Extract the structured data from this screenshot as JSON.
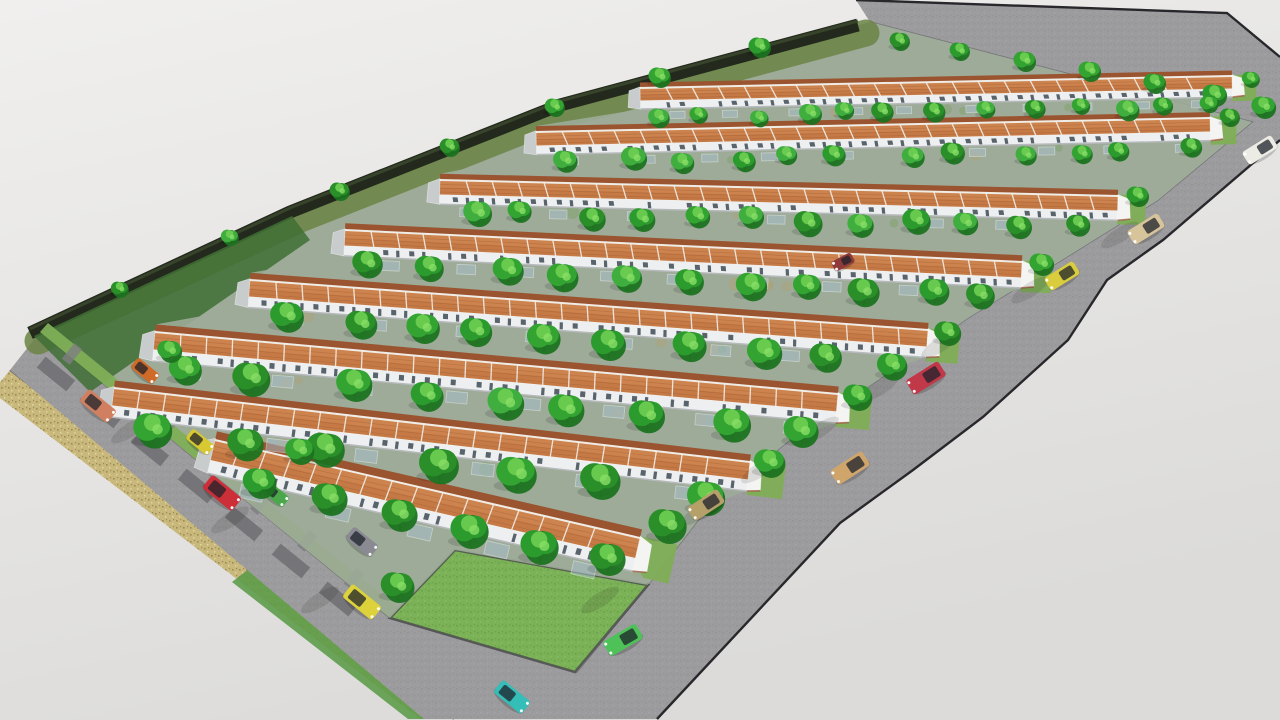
{
  "meta": {
    "kind": "3d-architectural-render",
    "subject": "terraced-housing-estate-site-plan",
    "canvas": {
      "w": 1280,
      "h": 720
    }
  },
  "palette": {
    "bg_top": "#f0efee",
    "bg_bottom": "#dcdbd9",
    "road": "#9c9c9e",
    "road_light": "#a6a6a8",
    "curb_dark": "#28282c",
    "curb_soft": "#6f6f72",
    "wall_band": "#c9b87b",
    "wall_speck1": "#9c8b55",
    "wall_speck2": "#e2d6a2",
    "hedge": "#23291c",
    "hedge_hi": "#3c4a2e",
    "hedge_verge": "#6b8444",
    "site_base": "#9dab98",
    "corner_grass": "#3f6f35",
    "lawn": "#7cb257",
    "lawn_speck": "#6aa248",
    "lawn_edge": "#4a4a4e",
    "verge": "#7fae57",
    "outer_grass": "#5d9c4a",
    "pad": "#6f6f72",
    "apron": "#7e7e81",
    "roof_far": "#9a5430",
    "roof_near": "#c57a46",
    "roof_light": "#d68f58",
    "tile_line": "#8c4c28",
    "ridge": "#f0ede7",
    "eave": "#f5f3ef",
    "wall_house": "#edeff0",
    "wall_shade": "#b7babc",
    "window": "#3d4a55",
    "brick": "#a14f3d",
    "gable_shade": "#c9cccd",
    "gable_lit": "#f4f4f2",
    "carport_glass": "#a9c0cf",
    "carport_frame": "#eef4f8",
    "tree_dark": "#1c7320",
    "tree_mids": [
      "#2c9b2e",
      "#33a431",
      "#2a8f29",
      "#3fae3f"
    ],
    "tree_light": "#6ecf52",
    "tree_light2": "#8adf66",
    "trunk": "#5a4a33",
    "shadow": "#000000"
  },
  "scene": {
    "seed": 7,
    "road_polygon": [
      [
        856,
        0
      ],
      [
        1227,
        13
      ],
      [
        1280,
        57
      ],
      [
        1280,
        140
      ],
      [
        1163,
        240
      ],
      [
        1107,
        280
      ],
      [
        1068,
        340
      ],
      [
        983,
        417
      ],
      [
        913,
        470
      ],
      [
        840,
        523
      ],
      [
        657,
        719
      ],
      [
        424,
        719
      ],
      [
        10,
        370
      ],
      [
        40,
        332
      ],
      [
        390,
        618
      ],
      [
        577,
        672
      ],
      [
        648,
        585
      ],
      [
        712,
        502
      ],
      [
        790,
        440
      ],
      [
        878,
        380
      ],
      [
        968,
        318
      ],
      [
        1065,
        258
      ],
      [
        1158,
        200
      ],
      [
        1252,
        122
      ],
      [
        870,
        22
      ]
    ],
    "outer_curb": [
      [
        856,
        0
      ],
      [
        1227,
        13
      ],
      [
        1280,
        57
      ]
    ],
    "outer_curb2": [
      [
        1280,
        140
      ],
      [
        1163,
        240
      ],
      [
        1107,
        280
      ],
      [
        1068,
        340
      ],
      [
        983,
        417
      ],
      [
        913,
        470
      ],
      [
        840,
        523
      ],
      [
        657,
        719
      ]
    ],
    "inner_boundary": [
      [
        40,
        332
      ],
      [
        390,
        618
      ],
      [
        577,
        672
      ],
      [
        648,
        585
      ],
      [
        712,
        502
      ],
      [
        790,
        440
      ],
      [
        878,
        380
      ],
      [
        968,
        318
      ],
      [
        1065,
        258
      ],
      [
        1158,
        200
      ],
      [
        1252,
        122
      ],
      [
        870,
        22
      ]
    ],
    "wall_band": [
      [
        10,
        370
      ],
      [
        454,
        719
      ],
      [
        420,
        719
      ],
      [
        -8,
        392
      ]
    ],
    "outer_grass_sliver": [
      [
        250,
        568
      ],
      [
        452,
        719
      ],
      [
        408,
        719
      ],
      [
        232,
        582
      ]
    ],
    "left_road_outer_line": [
      [
        10,
        370
      ],
      [
        454,
        719
      ]
    ],
    "site_polygon": [
      [
        40,
        332
      ],
      [
        390,
        618
      ],
      [
        577,
        672
      ],
      [
        648,
        585
      ],
      [
        712,
        502
      ],
      [
        790,
        440
      ],
      [
        878,
        380
      ],
      [
        968,
        318
      ],
      [
        1065,
        258
      ],
      [
        1158,
        200
      ],
      [
        1252,
        122
      ],
      [
        870,
        22
      ],
      [
        858,
        25
      ],
      [
        560,
        105
      ],
      [
        290,
        212
      ],
      [
        30,
        333
      ]
    ],
    "hedge_line": [
      [
        30,
        333
      ],
      [
        290,
        212
      ],
      [
        560,
        105
      ],
      [
        858,
        25
      ]
    ],
    "hedge_width": 13,
    "corner_grass_patch": [
      [
        34,
        336
      ],
      [
        292,
        216
      ],
      [
        310,
        240
      ],
      [
        90,
        392
      ]
    ],
    "left_verge": [
      [
        40,
        332
      ],
      [
        390,
        618
      ],
      [
        398,
        608
      ],
      [
        48,
        323
      ]
    ],
    "lawn": [
      [
        455,
        550
      ],
      [
        648,
        585
      ],
      [
        575,
        672
      ],
      [
        390,
        618
      ]
    ],
    "pads": [
      [
        56,
        374
      ],
      [
        103,
        411
      ],
      [
        150,
        449
      ],
      [
        197,
        486
      ],
      [
        244,
        524
      ],
      [
        291,
        561
      ],
      [
        338,
        599
      ]
    ],
    "pad_size": [
      38,
      14
    ],
    "pad_rot": 39,
    "apron_offset": [
      16,
      -20
    ],
    "apron_size": [
      10,
      20
    ],
    "rows": [
      {
        "x1": 640,
        "y1": 88,
        "x2": 1232,
        "y2": 76,
        "t": 13
      },
      {
        "x1": 536,
        "y1": 132,
        "x2": 1210,
        "y2": 118,
        "t": 14
      },
      {
        "x1": 440,
        "y1": 180,
        "x2": 1118,
        "y2": 196,
        "t": 15
      },
      {
        "x1": 345,
        "y1": 230,
        "x2": 1022,
        "y2": 262,
        "t": 16
      },
      {
        "x1": 250,
        "y1": 280,
        "x2": 928,
        "y2": 330,
        "t": 17
      },
      {
        "x1": 155,
        "y1": 332,
        "x2": 838,
        "y2": 394,
        "t": 18
      },
      {
        "x1": 114,
        "y1": 388,
        "x2": 750,
        "y2": 462,
        "t": 18
      },
      {
        "x1": 215,
        "y1": 440,
        "x2": 640,
        "y2": 538,
        "t": 21
      }
    ],
    "unit_spacing": 26,
    "window_spacing": 13,
    "lane_tree_counts": [
      13,
      12,
      12,
      11,
      10,
      9,
      7
    ],
    "lane_carport_counts": [
      10,
      10,
      9,
      9,
      8,
      8,
      6
    ],
    "front_strip": [
      [
        218,
        474
      ],
      [
        640,
        572
      ],
      [
        648,
        585
      ],
      [
        455,
        550
      ],
      [
        390,
        618
      ],
      [
        213,
        474
      ]
    ],
    "front_trees": [
      [
        260,
        484,
        15
      ],
      [
        330,
        500,
        16
      ],
      [
        400,
        516,
        16
      ],
      [
        470,
        532,
        17
      ],
      [
        540,
        548,
        17
      ],
      [
        608,
        560,
        16
      ]
    ],
    "hedge_trees": [
      [
        120,
        290,
        8
      ],
      [
        230,
        238,
        8
      ],
      [
        340,
        192,
        9
      ],
      [
        450,
        148,
        9
      ],
      [
        555,
        108,
        9
      ],
      [
        660,
        78,
        10
      ],
      [
        760,
        48,
        10
      ]
    ],
    "top_trees": [
      [
        900,
        42,
        9
      ],
      [
        960,
        52,
        9
      ],
      [
        1025,
        62,
        10
      ],
      [
        1090,
        72,
        10
      ],
      [
        1155,
        84,
        10
      ],
      [
        1215,
        96,
        11
      ],
      [
        1264,
        108,
        11
      ]
    ],
    "verge_trees": [
      [
        1251,
        80,
        8
      ],
      [
        1230,
        118,
        9
      ],
      [
        1138,
        197,
        10
      ],
      [
        1042,
        265,
        11
      ],
      [
        948,
        334,
        12
      ],
      [
        858,
        398,
        13
      ],
      [
        770,
        464,
        14
      ],
      [
        668,
        527,
        17
      ]
    ],
    "extra_trees": [
      [
        398,
        588,
        15
      ],
      [
        300,
        452,
        13
      ],
      [
        170,
        352,
        11
      ]
    ],
    "road_tree_shadows": [
      [
        700,
        512
      ],
      [
        760,
        470
      ],
      [
        820,
        430
      ],
      [
        880,
        388
      ],
      [
        940,
        345
      ],
      [
        1030,
        290
      ],
      [
        1120,
        235
      ],
      [
        130,
        430
      ],
      [
        230,
        520
      ],
      [
        320,
        600
      ],
      [
        600,
        600
      ]
    ],
    "cars": [
      {
        "name": "sedan-salmon",
        "x": 98,
        "y": 406,
        "rot": 39,
        "front": 1,
        "color": "#d08060",
        "len": 36,
        "wid": 16,
        "where": "west-road"
      },
      {
        "name": "hatchback-red",
        "x": 222,
        "y": 493,
        "rot": 39,
        "front": 1,
        "color": "#cc2f38",
        "len": 38,
        "wid": 17,
        "where": "west-road"
      },
      {
        "name": "sedan-yellow",
        "x": 362,
        "y": 602,
        "rot": 39,
        "front": 1,
        "color": "#ddd23c",
        "len": 38,
        "wid": 17,
        "where": "west-road"
      },
      {
        "name": "hatchback-teal",
        "x": 512,
        "y": 697,
        "rot": 39,
        "front": 1,
        "color": "#35bdb8",
        "len": 36,
        "wid": 16,
        "where": "south-road"
      },
      {
        "name": "carport-car-orange",
        "x": 145,
        "y": 371,
        "rot": 39,
        "front": 1,
        "color": "#d06a28",
        "len": 28,
        "wid": 13,
        "where": "carport"
      },
      {
        "name": "carport-car-yellow",
        "x": 200,
        "y": 442,
        "rot": 39,
        "front": 1,
        "color": "#d8c832",
        "len": 28,
        "wid": 13,
        "where": "carport"
      },
      {
        "name": "carport-car-green",
        "x": 275,
        "y": 494,
        "rot": 39,
        "front": 1,
        "color": "#4aa84a",
        "len": 28,
        "wid": 13,
        "where": "carport"
      },
      {
        "name": "carport-van-gray",
        "x": 362,
        "y": 542,
        "rot": 39,
        "front": 1,
        "color": "#8a8a92",
        "len": 32,
        "wid": 15,
        "where": "carport"
      },
      {
        "name": "carport-car-maroon",
        "x": 843,
        "y": 262,
        "rot": -28,
        "front": -1,
        "color": "#8e3a3a",
        "len": 22,
        "wid": 11,
        "where": "carport"
      },
      {
        "name": "sedan-white",
        "x": 1260,
        "y": 150,
        "rot": -32,
        "front": -1,
        "color": "#ecebe4",
        "len": 34,
        "wid": 15,
        "where": "east-road"
      },
      {
        "name": "van-beige",
        "x": 1146,
        "y": 229,
        "rot": -32,
        "front": -1,
        "color": "#d8c49a",
        "len": 36,
        "wid": 16,
        "where": "east-road"
      },
      {
        "name": "sedan-yellow-2",
        "x": 1062,
        "y": 276,
        "rot": -32,
        "front": -1,
        "color": "#d9cd3e",
        "len": 34,
        "wid": 15,
        "where": "east-road"
      },
      {
        "name": "sedan-crimson",
        "x": 926,
        "y": 378,
        "rot": -32,
        "front": -1,
        "color": "#c13848",
        "len": 38,
        "wid": 17,
        "where": "east-road"
      },
      {
        "name": "suv-tan",
        "x": 850,
        "y": 468,
        "rot": -33,
        "front": -1,
        "color": "#cfa56c",
        "len": 38,
        "wid": 17,
        "where": "east-road"
      },
      {
        "name": "suv-khaki",
        "x": 706,
        "y": 505,
        "rot": -33,
        "front": -1,
        "color": "#b6a06a",
        "len": 36,
        "wid": 16,
        "where": "east-road"
      },
      {
        "name": "sedan-green",
        "x": 623,
        "y": 640,
        "rot": -30,
        "front": -1,
        "color": "#4ec258",
        "len": 38,
        "wid": 17,
        "where": "south-road"
      }
    ]
  }
}
